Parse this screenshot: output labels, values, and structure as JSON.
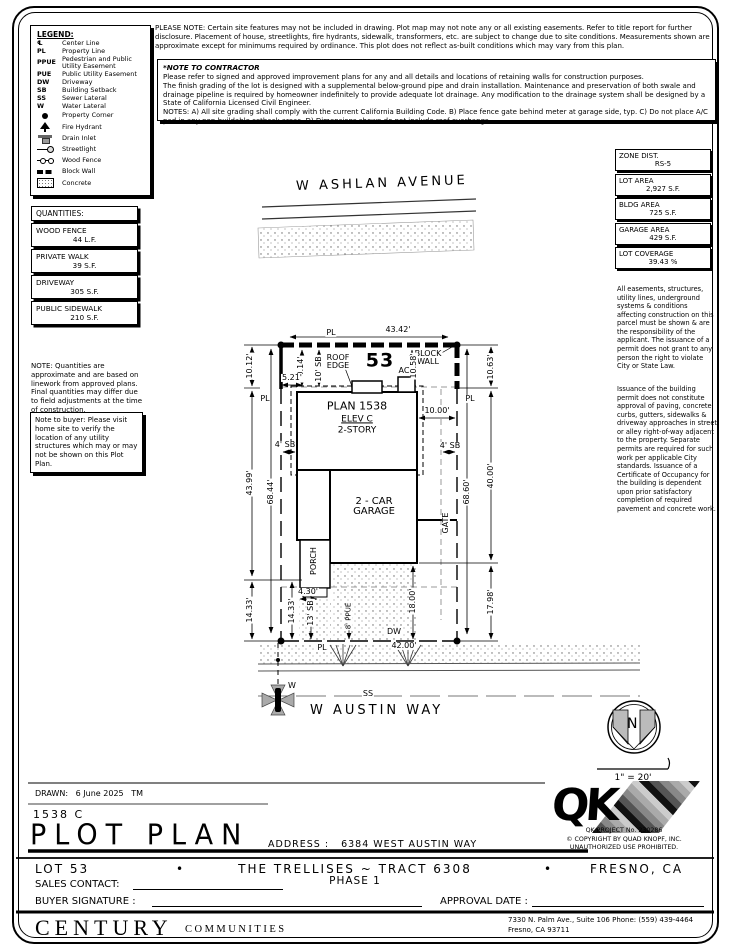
{
  "legend": {
    "title": "LEGEND:",
    "items": [
      {
        "abbr": "℄",
        "label": "Center Line"
      },
      {
        "abbr": "PL",
        "label": "Property Line"
      },
      {
        "abbr": "PPUE",
        "label": "Pedestrian and Public Utility Easement"
      },
      {
        "abbr": "PUE",
        "label": "Public Utility Easement"
      },
      {
        "abbr": "DW",
        "label": "Driveway"
      },
      {
        "abbr": "SB",
        "label": "Building Setback"
      },
      {
        "abbr": "SS",
        "label": "Sewer Lateral"
      },
      {
        "abbr": "W",
        "label": "Water Lateral"
      },
      {
        "icon": "property-corner",
        "label": "Property Corner"
      },
      {
        "icon": "fire-hydrant",
        "label": "Fire Hydrant"
      },
      {
        "icon": "drain-inlet",
        "label": "Drain Inlet"
      },
      {
        "icon": "streetlight",
        "label": "Streetlight"
      },
      {
        "icon": "wood-fence",
        "label": "Wood Fence"
      },
      {
        "icon": "block-wall",
        "label": "Block Wall"
      },
      {
        "icon": "concrete",
        "label": "Concrete"
      }
    ]
  },
  "notes": {
    "please_note": "PLEASE NOTE:  Certain site features may not be included in drawing.  Plot map may not note any or all existing easements. Refer to title report for further disclosure.  Placement of house, streetlights, fire hydrants, sidewalk, transformers, etc. are subject to change due to site conditions.  Measurements shown are approximate except for minimums required by ordinance.  This plot does not reflect as-built conditions which may vary from this plan.",
    "contractor_title": "*NOTE TO CONTRACTOR",
    "contractor_p1": "Please refer to signed and approved improvement plans for any and all details and locations of retaining walls for construction purposes.",
    "contractor_p2": "The finish grading of the lot is designed with a supplemental below-ground pipe and drain installation.  Maintenance and preservation of both swale and drainage pipeline is required by homeowner indefinitely to provide adequate lot drainage.  Any modification to the drainage system shall be designed by a State of California Licensed Civil Engineer.",
    "contractor_p3": "NOTES:  A) All site grading shall comply with the current California Building Code.  B) Place fence gate behind meter at garage side, typ.  C) Do not place A/C pad in any non-buildable setback areas.  D) Dimensions shown do not include roof overhangs."
  },
  "site_info": [
    {
      "label": "ZONE DIST.",
      "value": "RS-5"
    },
    {
      "label": "LOT AREA",
      "value": "2,927 S.F."
    },
    {
      "label": "BLDG AREA",
      "value": "725 S.F."
    },
    {
      "label": "GARAGE AREA",
      "value": "429 S.F."
    },
    {
      "label": "LOT COVERAGE",
      "value": "39.43 %"
    }
  ],
  "quantities": {
    "title": "QUANTITIES:",
    "rows": [
      {
        "label": "WOOD FENCE",
        "value": "44 L.F."
      },
      {
        "label": "PRIVATE WALK",
        "value": "39 S.F."
      },
      {
        "label": "DRIVEWAY",
        "value": "305 S.F."
      },
      {
        "label": "PUBLIC SIDEWALK",
        "value": "210 S.F."
      }
    ],
    "note": "NOTE: Quantities are approximate and are based on linework from approved plans.  Final quantities may differ due to field adjustments at the time of construction.",
    "buyer_note": "Note to buyer: Please visit home site to verify the location of any utility structures which may or may not be shown on this Plot Plan."
  },
  "right_notes": {
    "p1": "All easements, structures, utility lines, underground systems & conditions affecting construction on this parcel must be shown & are the responsibility of the applicant. The issuance of a permit does not grant to any person the right to violate City or State Law.",
    "p2": "Issuance of the building permit does not constitute approval of paving, concrete curbs, gutters, sidewalks & driveway approaches in street or alley right-of-way adjacent to the property. Separate permits are required for such work per applicable City standards. Issuance of a Certificate of Occupancy for the building is dependent upon prior satisfactory completion of required pavement and concrete work."
  },
  "plot": {
    "street_top": "W ASHLAN AVENUE",
    "street_bottom": "W AUSTIN WAY",
    "north_letter": "N",
    "scale_text": "1\" = 20'",
    "labels": [
      {
        "t": "PL",
        "x": 331,
        "y": 333
      },
      {
        "t": "43.42'",
        "x": 398,
        "y": 330
      },
      {
        "t": "53",
        "x": 380,
        "y": 361,
        "s": 19,
        "cls": "bold"
      },
      {
        "t": "BLOCK\nWALL",
        "x": 428,
        "y": 358
      },
      {
        "t": "ROOF\nEDGE",
        "x": 338,
        "y": 362
      },
      {
        "t": "10' SB",
        "x": 319,
        "y": 369,
        "r": -90
      },
      {
        "t": "10.14'",
        "x": 301,
        "y": 369,
        "r": -90
      },
      {
        "t": "10.12'",
        "x": 250,
        "y": 366,
        "r": -90
      },
      {
        "t": "AC",
        "x": 404,
        "y": 371
      },
      {
        "t": "10.58'",
        "x": 414,
        "y": 366,
        "r": -90
      },
      {
        "t": "5.21'",
        "x": 292,
        "y": 378
      },
      {
        "t": "PL",
        "x": 265,
        "y": 399
      },
      {
        "t": "PL",
        "x": 470,
        "y": 399
      },
      {
        "t": "PLAN 1538",
        "x": 357,
        "y": 406,
        "s": 11
      },
      {
        "t": "ELEV C",
        "x": 357,
        "y": 420,
        "s": 9,
        "cls": "und"
      },
      {
        "t": "2-STORY",
        "x": 357,
        "y": 431,
        "s": 9
      },
      {
        "t": "10.00'",
        "x": 437,
        "y": 411
      },
      {
        "t": "4' SB",
        "x": 285,
        "y": 445
      },
      {
        "t": "4' SB",
        "x": 450,
        "y": 446
      },
      {
        "t": "43.99'",
        "x": 250,
        "y": 483,
        "r": -90
      },
      {
        "t": "68.44'",
        "x": 271,
        "y": 492,
        "r": -90
      },
      {
        "t": "2 - CAR\nGARAGE",
        "x": 374,
        "y": 507,
        "s": 10
      },
      {
        "t": "GATE",
        "x": 446,
        "y": 523,
        "r": -90
      },
      {
        "t": "68.60'",
        "x": 467,
        "y": 492,
        "r": -90
      },
      {
        "t": "40.00'",
        "x": 491,
        "y": 476,
        "r": -90
      },
      {
        "t": "10.63'",
        "x": 491,
        "y": 367,
        "r": -90
      },
      {
        "t": "PORCH",
        "x": 314,
        "y": 561,
        "r": -90
      },
      {
        "t": "4.30'",
        "x": 308,
        "y": 592
      },
      {
        "t": "14.33'",
        "x": 250,
        "y": 610,
        "r": -90
      },
      {
        "t": "14.33'",
        "x": 292,
        "y": 611,
        "r": -90
      },
      {
        "t": "13' SB",
        "x": 311,
        "y": 613,
        "r": -90
      },
      {
        "t": "8' PPUE",
        "x": 349,
        "y": 616,
        "r": -90,
        "s": 7
      },
      {
        "t": "18.00'",
        "x": 413,
        "y": 601,
        "r": -90
      },
      {
        "t": "DW",
        "x": 394,
        "y": 632
      },
      {
        "t": "17.98'",
        "x": 491,
        "y": 602,
        "r": -90
      },
      {
        "t": "PL",
        "x": 322,
        "y": 648
      },
      {
        "t": "42.00'",
        "x": 404,
        "y": 646
      },
      {
        "t": "SS",
        "x": 368,
        "y": 694
      },
      {
        "t": "W",
        "x": 292,
        "y": 686
      }
    ]
  },
  "title_block": {
    "drawn_label": "DRAWN:",
    "drawn_date": "6 June 2025",
    "drawn_by": "TM",
    "plan_code": "1538  C",
    "sheet_title": "PLOT PLAN",
    "address_label": "ADDRESS :",
    "address": "6384 WEST AUSTIN WAY",
    "lot": "LOT 53",
    "bullet": "•",
    "tract": "THE TRELLISES ~ TRACT 6308",
    "phase": "PHASE 1",
    "city": "FRESNO, CA",
    "sales_contact_label": "SALES CONTACT:",
    "buyer_signature_label": "BUYER SIGNATURE :",
    "approval_date_label": "APPROVAL DATE :"
  },
  "qk": {
    "logo": "QK",
    "project": "QK PROJECT No. 230286",
    "copyright": "©  COPYRIGHT BY QUAD KNOPF, INC.",
    "unauthorized": "UNAUTHORIZED USE PROHIBITED."
  },
  "brand": {
    "main": "CENTURY",
    "sub": "COMMUNITIES",
    "firm_line1": "7330 N. Palm Ave., Suite 106    Phone:  (559) 439-4464",
    "firm_line2": "Fresno, CA  93711"
  }
}
